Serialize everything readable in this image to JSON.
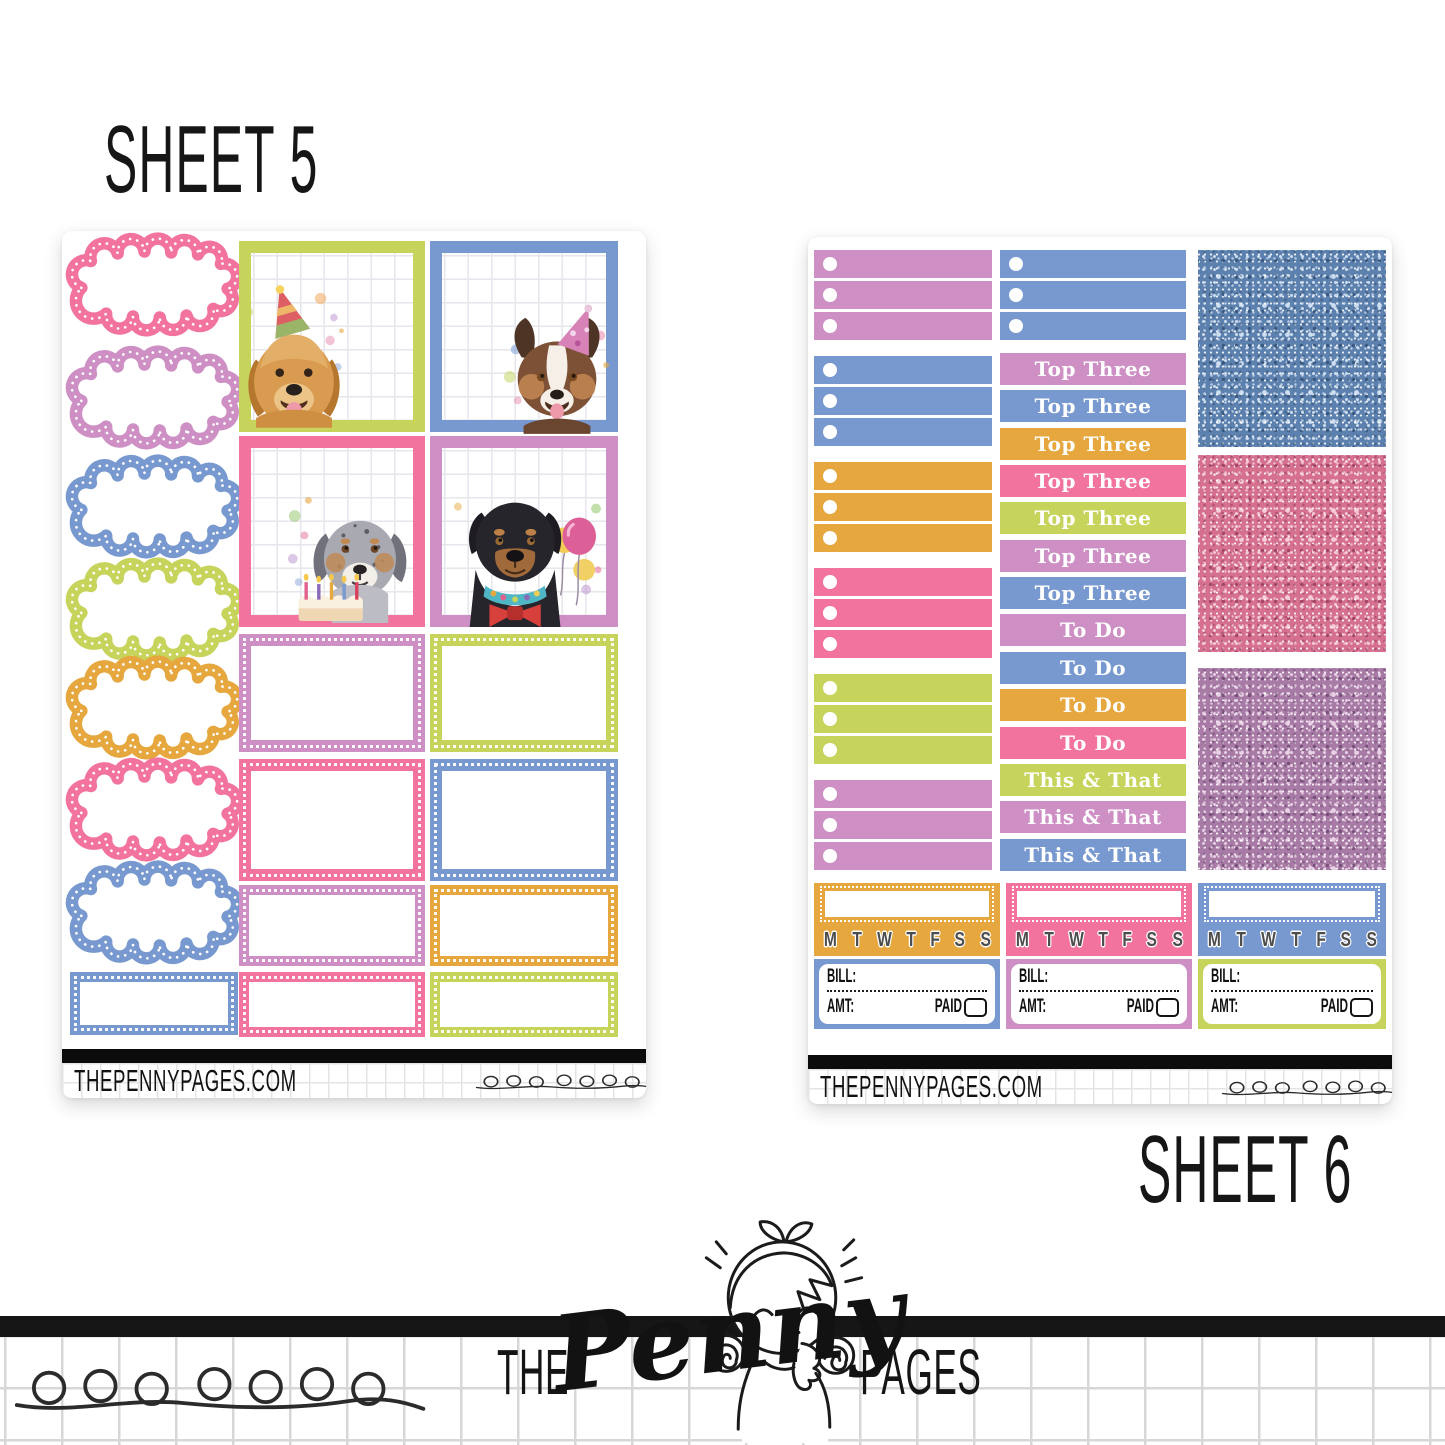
{
  "titles": {
    "sheet5": "SHEET 5",
    "sheet6": "SHEET 6"
  },
  "palette": {
    "pink": "#F2739D",
    "purple": "#CD8FC4",
    "blue": "#7899D0",
    "green": "#C6D45C",
    "orange": "#E5A73E"
  },
  "sheet5": {
    "footer": {
      "site": "THEPENNYPAGES.COM",
      "label_line1": "DOG BIRTHDAY",
      "label_line2": "LARGE BOXES"
    },
    "clouds": [
      "pink",
      "purple",
      "blue",
      "green",
      "orange",
      "pink",
      "blue"
    ],
    "bottom_left_box_color": "blue",
    "photo_boxes": [
      {
        "color": "green",
        "dog": "golden retriever with party hat"
      },
      {
        "color": "blue",
        "dog": "australian shepherd with party hat"
      },
      {
        "color": "pink",
        "dog": "merle dog with birthday cake"
      },
      {
        "color": "purple",
        "dog": "rottweiler with bow tie and balloons"
      }
    ],
    "full_boxes": [
      "purple",
      "green",
      "pink",
      "blue"
    ],
    "half_boxes": [
      "purple",
      "orange",
      "pink",
      "green"
    ]
  },
  "sheet6": {
    "footer": {
      "site": "THEPENNYPAGES.COM",
      "label_line1": "DOG BIRTHDAY",
      "label_line2": "HEADERS / CHECKLISTS"
    },
    "checklist_groups_col1": [
      "purple",
      "blue",
      "orange",
      "pink",
      "green",
      "purple"
    ],
    "checklist_group_col2": "blue",
    "rows_per_group": 3,
    "headers": [
      {
        "label": "Top Three",
        "color": "purple"
      },
      {
        "label": "Top Three",
        "color": "blue"
      },
      {
        "label": "Top Three",
        "color": "orange"
      },
      {
        "label": "Top Three",
        "color": "pink"
      },
      {
        "label": "Top Three",
        "color": "green"
      },
      {
        "label": "Top Three",
        "color": "purple"
      },
      {
        "label": "Top Three",
        "color": "blue"
      },
      {
        "label": "To Do",
        "color": "purple"
      },
      {
        "label": "To Do",
        "color": "blue"
      },
      {
        "label": "To Do",
        "color": "orange"
      },
      {
        "label": "To Do",
        "color": "pink"
      },
      {
        "label": "This & That",
        "color": "green"
      },
      {
        "label": "This & That",
        "color": "purple"
      },
      {
        "label": "This & That",
        "color": "blue"
      }
    ],
    "glitter_swatches": [
      {
        "name": "blue glitter",
        "base": "#5D81AE",
        "light": "#CFDFF2",
        "dark": "#39587F"
      },
      {
        "name": "pink glitter",
        "base": "#D5718F",
        "light": "#F7CDD9",
        "dark": "#A34568"
      },
      {
        "name": "purple glitter",
        "base": "#A87BA6",
        "light": "#E9D2E6",
        "dark": "#77507A"
      }
    ],
    "habit_trackers": {
      "colors": [
        "orange",
        "pink",
        "blue"
      ],
      "days": [
        "M",
        "T",
        "W",
        "T",
        "F",
        "S",
        "S"
      ]
    },
    "bill_boxes": {
      "colors": [
        "blue",
        "purple",
        "green"
      ],
      "bill_label": "BILL:",
      "amt_label": "AMT:",
      "paid_label": "PAID"
    }
  },
  "branding": {
    "the": "THE",
    "penny": "Penny",
    "pages": "PAGES"
  }
}
